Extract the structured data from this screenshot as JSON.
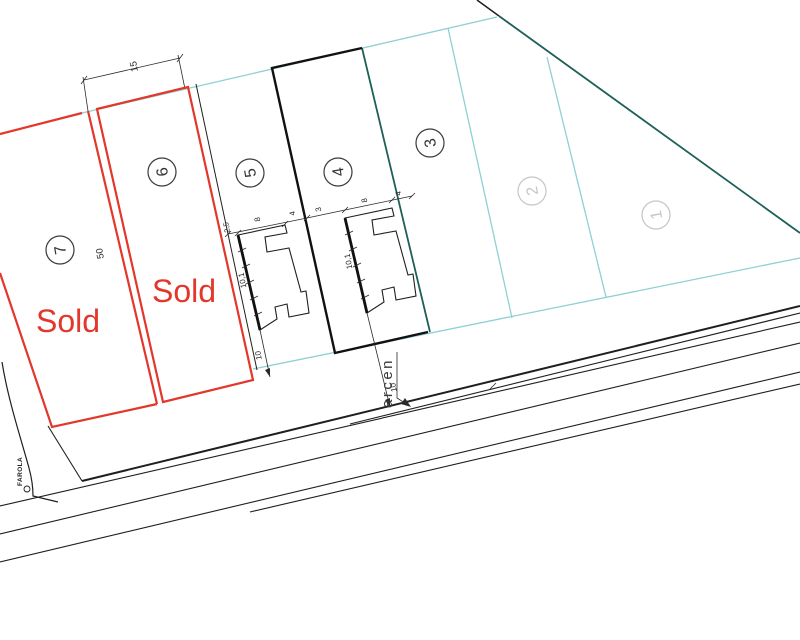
{
  "plan": {
    "lots": [
      {
        "number": "1"
      },
      {
        "number": "2"
      },
      {
        "number": "3"
      },
      {
        "number": "4"
      },
      {
        "number": "5"
      },
      {
        "number": "6",
        "status": "Sold"
      },
      {
        "number": "7",
        "status": "Sold"
      }
    ],
    "labels": {
      "arcen": "arcen",
      "farola": "FAROLA"
    },
    "dimensions": {
      "lot6_width": "15",
      "lot6_depth": "50",
      "b5_offset": "2,5",
      "b5_width": "8",
      "b5_ext": "4",
      "b5_depth": "10,1",
      "b5_front": "10",
      "gap": "3",
      "b4_width": "8",
      "b4_ext": "4",
      "b4_depth": "10,1",
      "b4_front": "10"
    },
    "colors": {
      "sold_red": "#e2372a",
      "boundary_cyan": "#8fd0d4",
      "boundary_teal": "#1e6057",
      "line_black": "#1f1f1f",
      "muted_gray": "#c5c5c5"
    }
  }
}
